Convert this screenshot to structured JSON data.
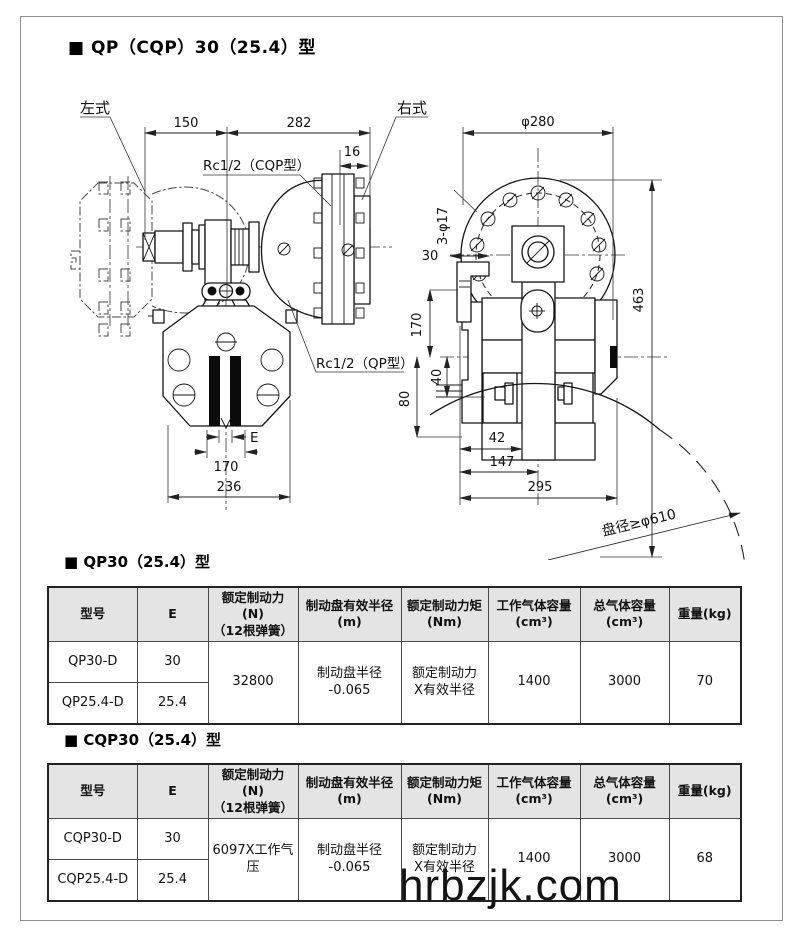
{
  "document": {
    "title": "■ QP（CQP）30（25.4）型",
    "watermark": "hrbzjk.com"
  },
  "drawing": {
    "labels": {
      "left_type": "左式",
      "right_type": "右式",
      "rc_cqp": "Rc1/2（CQP型）",
      "rc_qp": "Rc1/2（QP型）",
      "disc_dia_note": "盘径≥φ610",
      "bolt_holes": "3-φ17"
    },
    "dimensions": {
      "left_view": {
        "d150": "150",
        "d282": "282",
        "d16": "16",
        "dE": "E",
        "d170": "170",
        "d236": "236"
      },
      "right_view": {
        "phi280": "φ280",
        "d30": "30",
        "d170": "170",
        "d40": "40",
        "d80": "80",
        "d463": "463",
        "d42": "42",
        "d147": "147",
        "d295": "295"
      }
    }
  },
  "tables": [
    {
      "title": "■ QP30（25.4）型",
      "headers": {
        "model": "型号",
        "e": "E",
        "force": "额定制动力(N)\n（12根弹簧）",
        "radius": "制动盘有效半径\n(m)",
        "torque": "额定制动力矩\n(Nm)",
        "working_volume": "工作气体容量\n(cm³)",
        "total_volume": "总气体容量\n(cm³)",
        "weight": "重量(kg)"
      },
      "rows": [
        {
          "model": "QP30-D",
          "e": "30"
        },
        {
          "model": "QP25.4-D",
          "e": "25.4"
        }
      ],
      "shared": {
        "force": "32800",
        "radius": "制动盘半径\n-0.065",
        "torque": "额定制动力\nX有效半径",
        "working_volume": "1400",
        "total_volume": "3000",
        "weight": "70"
      }
    },
    {
      "title": "■ CQP30（25.4）型",
      "headers": {
        "model": "型号",
        "e": "E",
        "force": "额定制动力(N)\n（12根弹簧）",
        "radius": "制动盘有效半径\n(m)",
        "torque": "额定制动力矩\n(Nm)",
        "working_volume": "工作气体容量\n(cm³)",
        "total_volume": "总气体容量\n(cm³)",
        "weight": "重量(kg)"
      },
      "rows": [
        {
          "model": "CQP30-D",
          "e": "30"
        },
        {
          "model": "CQP25.4-D",
          "e": "25.4"
        }
      ],
      "shared": {
        "force": "6097X工作气\n压",
        "radius": "制动盘半径\n-0.065",
        "torque": "额定制动力\nX有效半径",
        "working_volume": "1400",
        "total_volume": "3000",
        "weight": "68"
      }
    }
  ]
}
